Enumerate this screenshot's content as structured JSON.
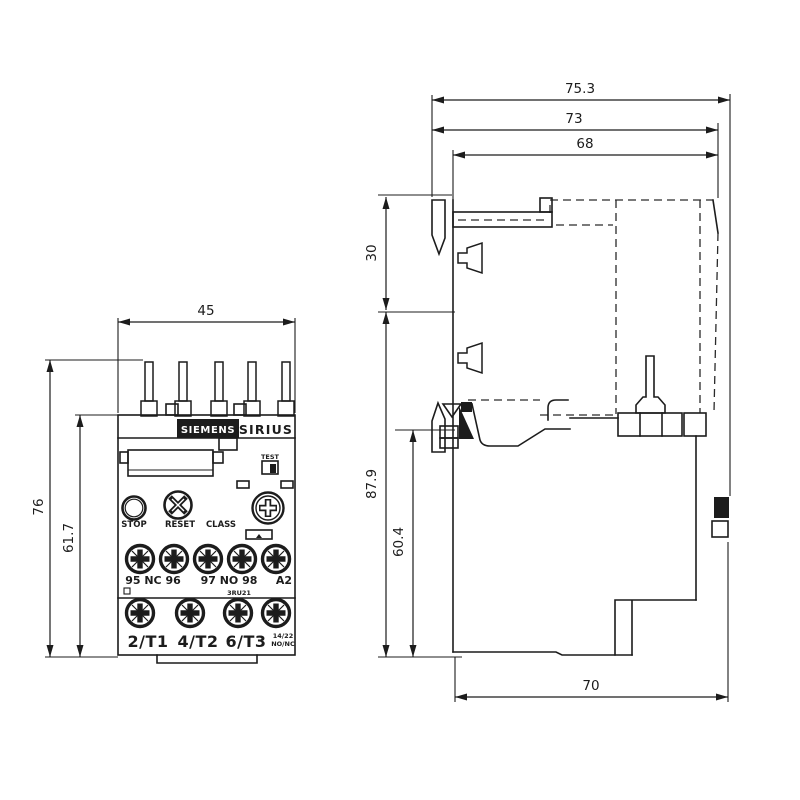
{
  "front": {
    "brand": "SIEMENS",
    "series": "SIRIUS",
    "test_label": "TEST",
    "stop_label": "STOP",
    "reset_label": "RESET",
    "class_label": "CLASS",
    "type_code": "3RU21",
    "upper_terminals": {
      "nc_group": "95 NC 96",
      "no_group": "97 NO 98",
      "a2": "A2"
    },
    "lower_terminals": [
      "2/T1",
      "4/T2",
      "6/T3"
    ],
    "aux_terminal": {
      "top": "14/22",
      "bottom": "NO/NC"
    }
  },
  "dims": {
    "front_width": "45",
    "front_height_total": "76",
    "front_height_body": "61.7",
    "side_depth_total": "75.3",
    "side_depth_mid": "73",
    "side_depth_body": "68",
    "side_pin_offset": "30",
    "side_height_total": "87.9",
    "side_height_body": "60.4",
    "side_depth_bottom": "70"
  },
  "colors": {
    "line": "#1c1c1c",
    "background": "#ffffff"
  }
}
